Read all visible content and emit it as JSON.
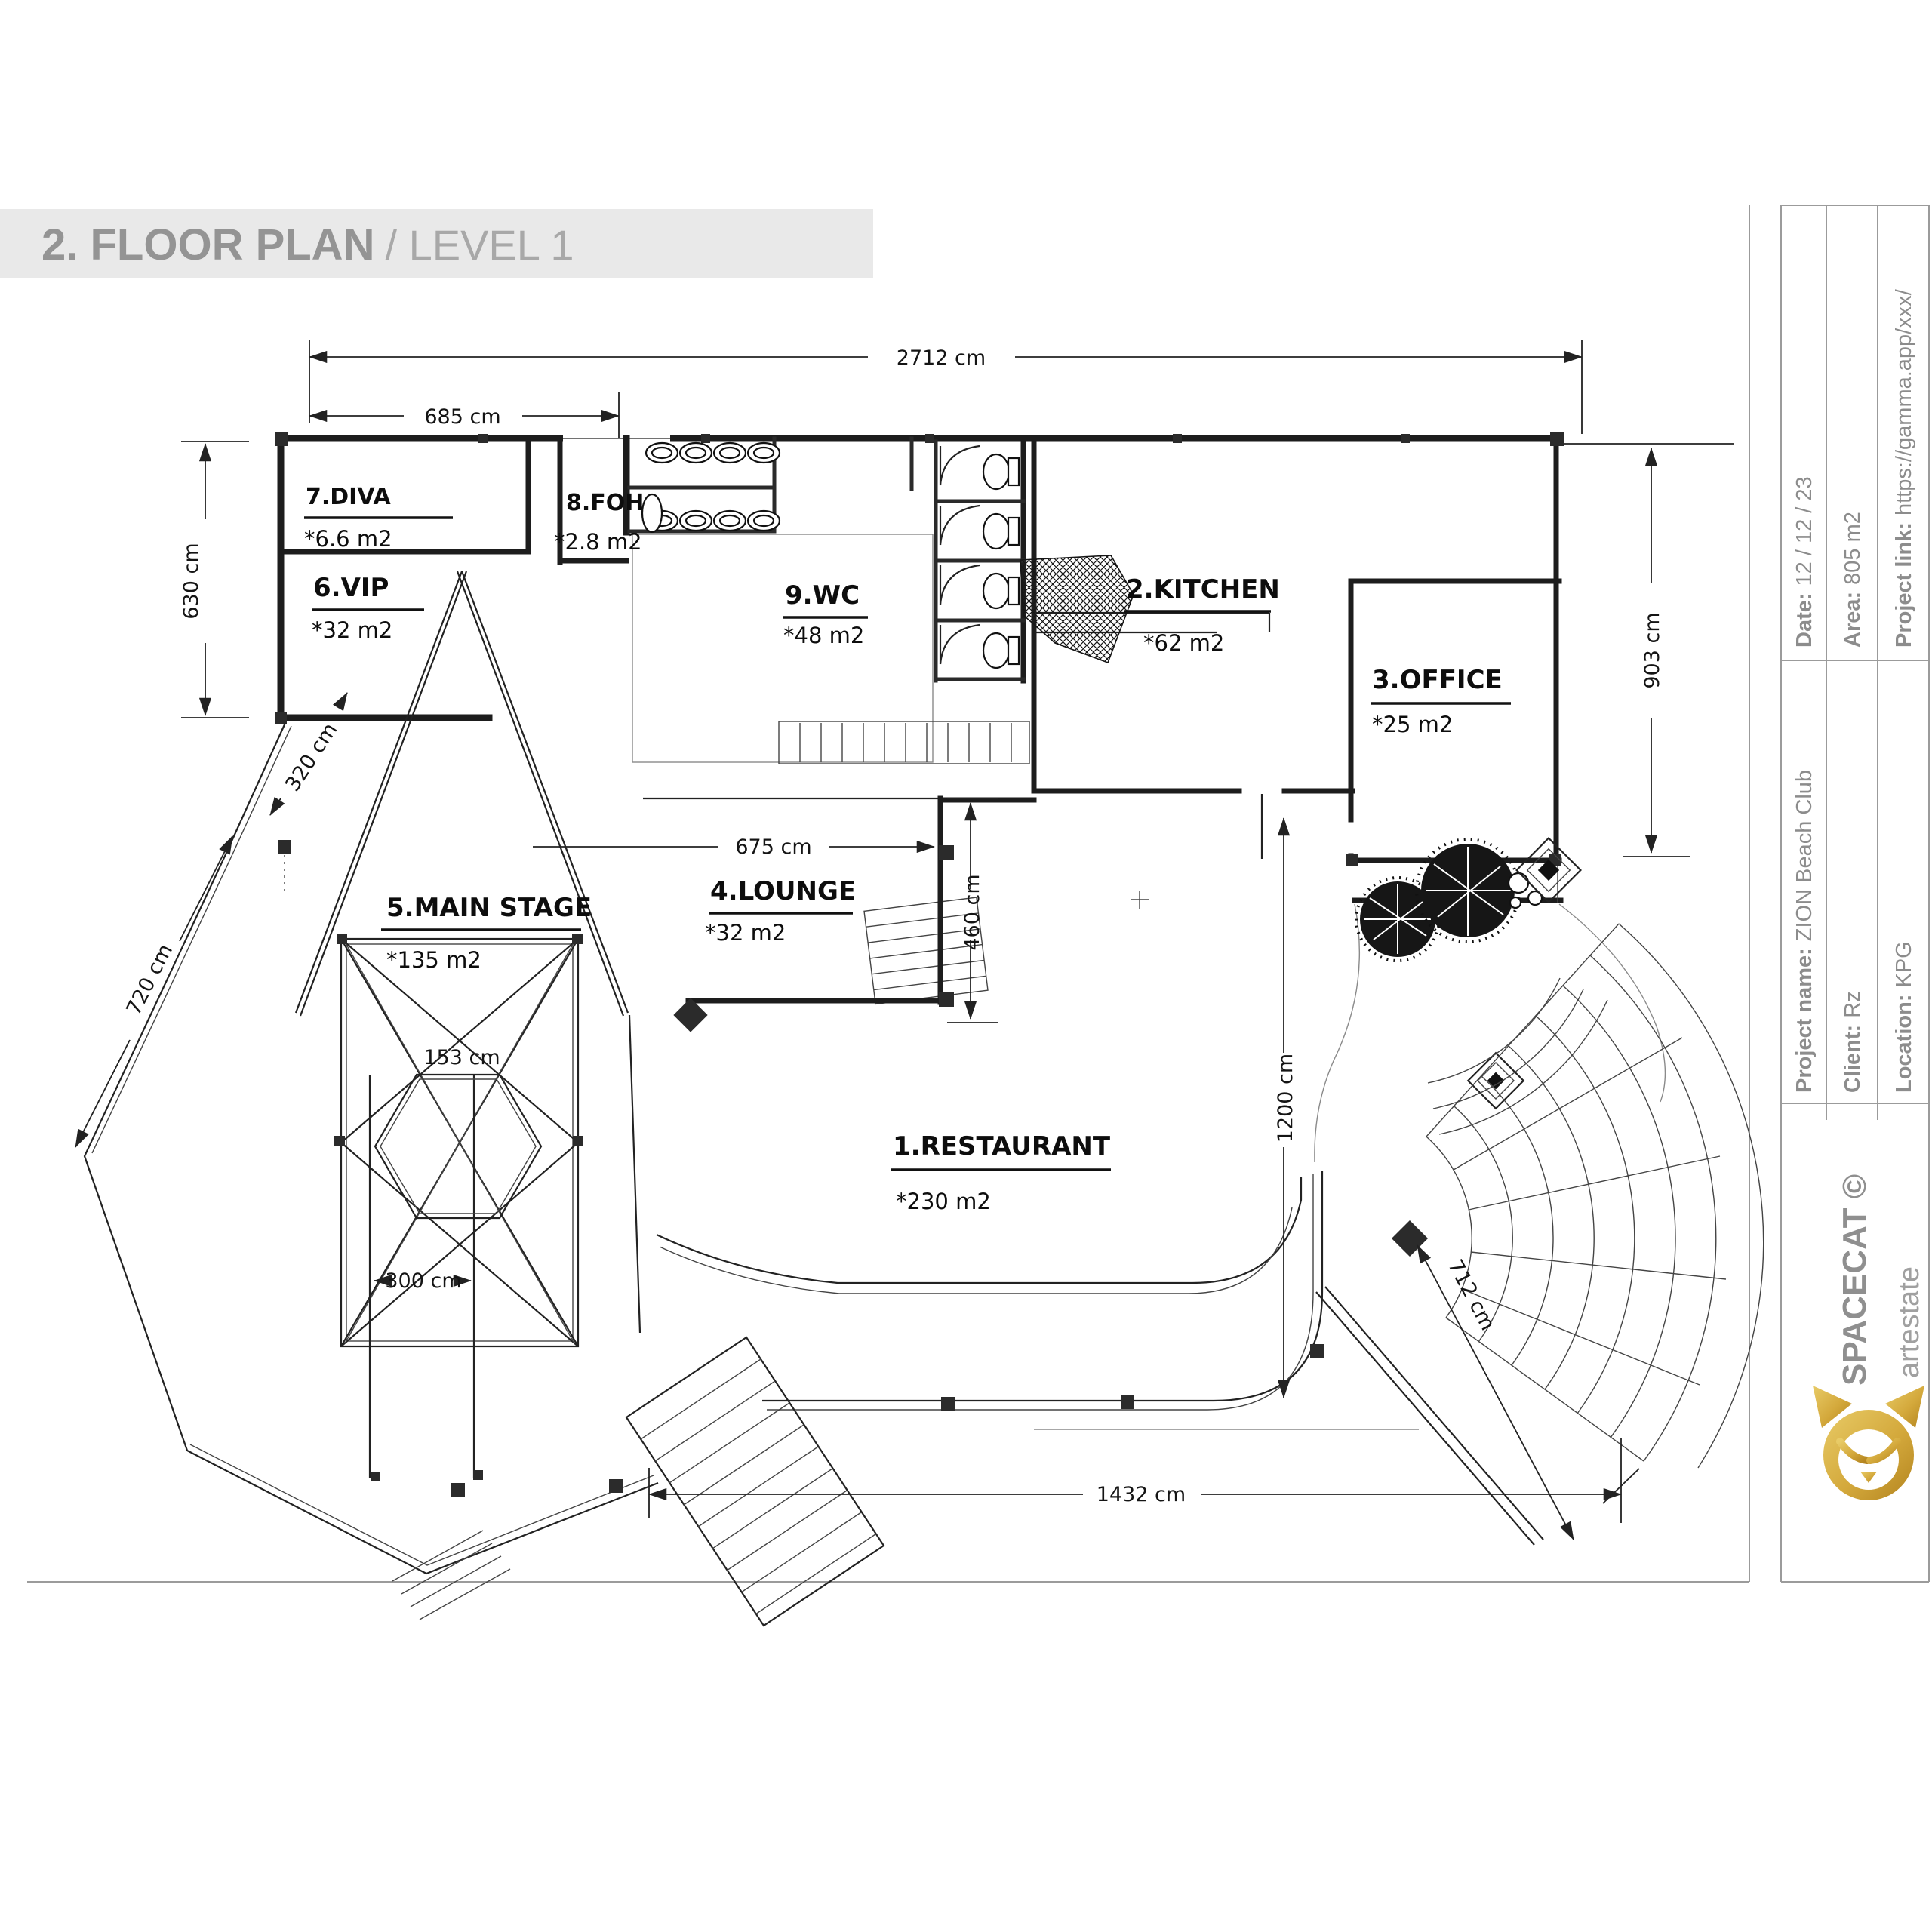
{
  "title": {
    "main": "2. FLOOR PLAN",
    "sub": "/ LEVEL 1"
  },
  "sidebar": {
    "fields": [
      {
        "label": "Date:",
        "value": "12 / 12 / 23"
      },
      {
        "label": "Area:",
        "value": "805 m2"
      },
      {
        "label": "Project link:",
        "value": "https://gamma.app/xxx/"
      },
      {
        "label": "Project name:",
        "value": "ZION Beach Club"
      },
      {
        "label": "Client:",
        "value": "Rz"
      },
      {
        "label": "Location:",
        "value": "KPG"
      }
    ],
    "brand": "SPACECAT ©",
    "brand_sub": "artestate",
    "logo_icon": "cat-logo",
    "logo_color": "#D4A93C"
  },
  "plan": {
    "rooms": [
      {
        "name": "1.RESTAURANT",
        "area": "*230 m2"
      },
      {
        "name": "2.KITCHEN",
        "area": "*62 m2"
      },
      {
        "name": "3.OFFICE",
        "area": "*25 m2"
      },
      {
        "name": "4.LOUNGE",
        "area": "*32 m2"
      },
      {
        "name": "5.MAIN STAGE",
        "area": "*135 m2"
      },
      {
        "name": "6.VIP",
        "area": "*32 m2"
      },
      {
        "name": "7.DIVA",
        "area": "*6.6 m2"
      },
      {
        "name": "8.FOH",
        "area": "*2.8 m2"
      },
      {
        "name": "9.WC",
        "area": "*48 m2"
      }
    ],
    "dims": {
      "d2712": "2712 cm",
      "d685": "685 cm",
      "d630": "630 cm",
      "d903": "903 cm",
      "d675": "675 cm",
      "d460": "460 cm",
      "d1200": "1200 cm",
      "d153": "153 cm",
      "d300": "300 cm",
      "d1432": "1432 cm",
      "d712": "712 cm",
      "d320": "320 cm",
      "d720": "720 cm"
    }
  }
}
